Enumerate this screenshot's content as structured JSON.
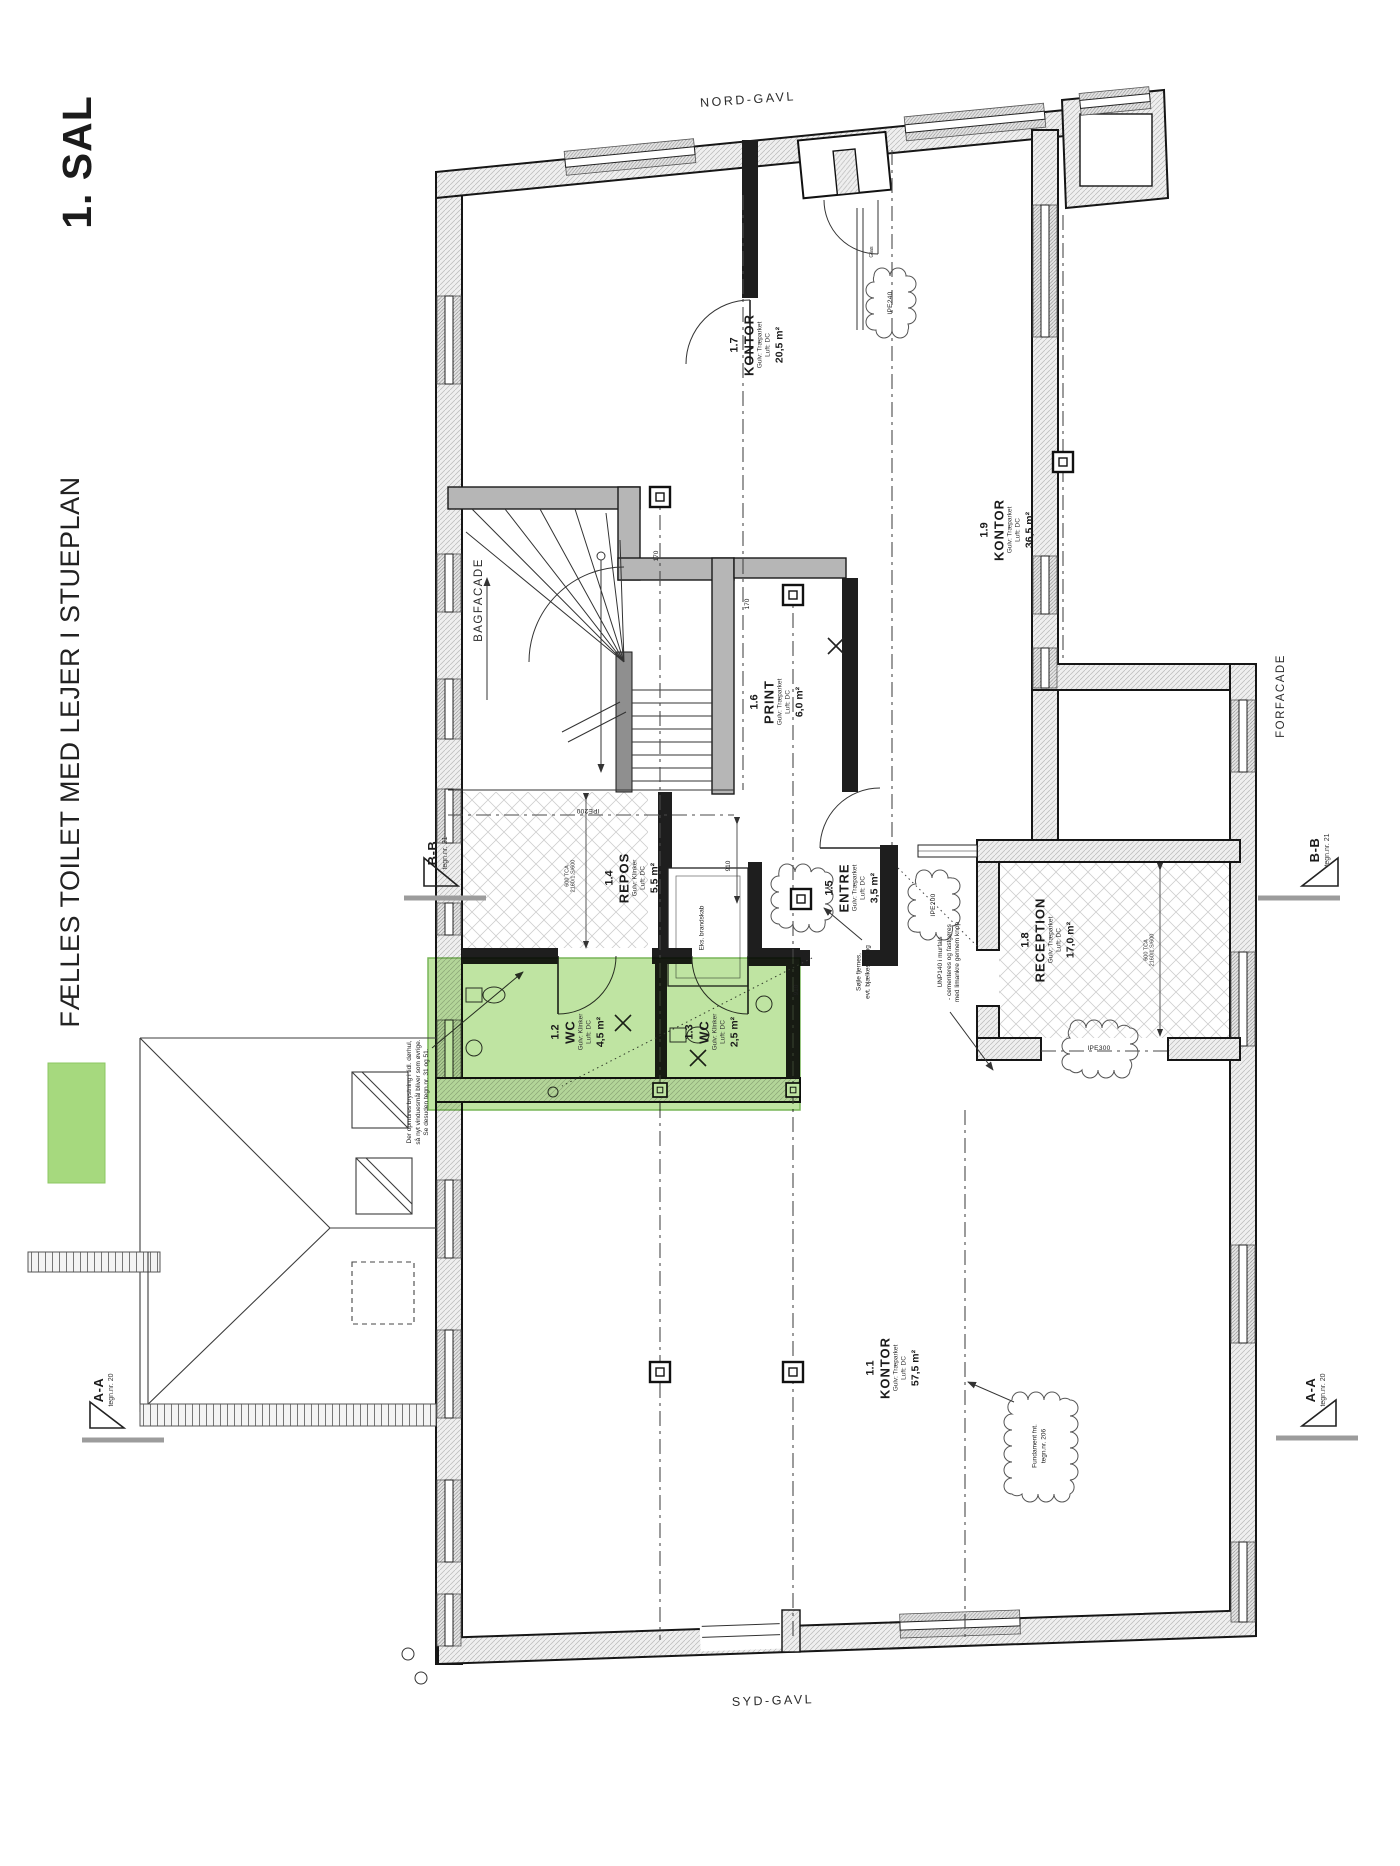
{
  "sheet": {
    "title": "1. SAL",
    "note": "FÆLLES TOILET MED LEJER I STUEPLAN",
    "legend_color": "#a6d97e"
  },
  "facades": {
    "north": "NORD-GAVL",
    "south": "SYD-GAVL",
    "back": "BAGFACADE",
    "front": "FORFACADE"
  },
  "sections": {
    "bb": {
      "label": "B-B",
      "ref": "tegn.nr. 21"
    },
    "aa": {
      "label": "A-A",
      "ref": "tegn.nr. 20"
    }
  },
  "rooms": [
    {
      "id": "1.1",
      "name": "KONTOR",
      "floor": "Gulv: Træparket",
      "vent": "Luft: DC",
      "area": "57,5 m²"
    },
    {
      "id": "1.2",
      "name": "WC",
      "floor": "Gulv: Klinker",
      "vent": "Luft: DC",
      "area": "4,5 m²"
    },
    {
      "id": "1.3",
      "name": "WC",
      "floor": "Gulv: Klinker",
      "vent": "Luft: DC",
      "area": "2,5 m²"
    },
    {
      "id": "1.4",
      "name": "REPOS",
      "floor": "Gulv: Klinker",
      "vent": "Luft: DC",
      "area": "5,5 m²"
    },
    {
      "id": "1.5",
      "name": "ENTRE",
      "floor": "Gulv: Træparket",
      "vent": "Luft: DC",
      "area": "3,5 m²"
    },
    {
      "id": "1.6",
      "name": "PRINT",
      "floor": "Gulv: Træparket",
      "vent": "Luft: DC",
      "area": "6,0 m²"
    },
    {
      "id": "1.7",
      "name": "KONTOR",
      "floor": "Gulv: Træparket",
      "vent": "Luft: DC",
      "area": "20,5 m²"
    },
    {
      "id": "1.8",
      "name": "RECEPTION",
      "floor": "Gulv: Træparket",
      "vent": "Luft: DC",
      "area": "17,0 m²"
    },
    {
      "id": "1.9",
      "name": "KONTOR",
      "floor": "Gulv: Træparket",
      "vent": "Luft: DC",
      "area": "36,5 m²"
    }
  ],
  "annotations": {
    "brystning": {
      "l1": "Der opmures brystning i tidl. dørhul,",
      "l2": "så nyt vinduesmål bliver som øvrige.",
      "l3": "Se desuden tegn.nr. 31 og 51."
    },
    "unp": {
      "l1": "UNP140 i murfals",
      "l2": "- cementeres og fastgøres",
      "l3": "med limankre gennem knop"
    },
    "soejle": {
      "l1": "Søjle fjernes,",
      "l2": "evt. bjælkesamling"
    },
    "brandskab": "Eks. brandskab",
    "glas": "Glas",
    "fundament": {
      "l1": "Fundament fnt.",
      "l2": "tegn.nr. 206"
    }
  },
  "beams": {
    "ipe240": "IPE240",
    "ipe200": "IPE200",
    "ipe300": "IPE300"
  },
  "dims": {
    "d910": "910",
    "d170": "170",
    "spec1": "600 TCA",
    "spec2": "2160/1.S/600"
  }
}
